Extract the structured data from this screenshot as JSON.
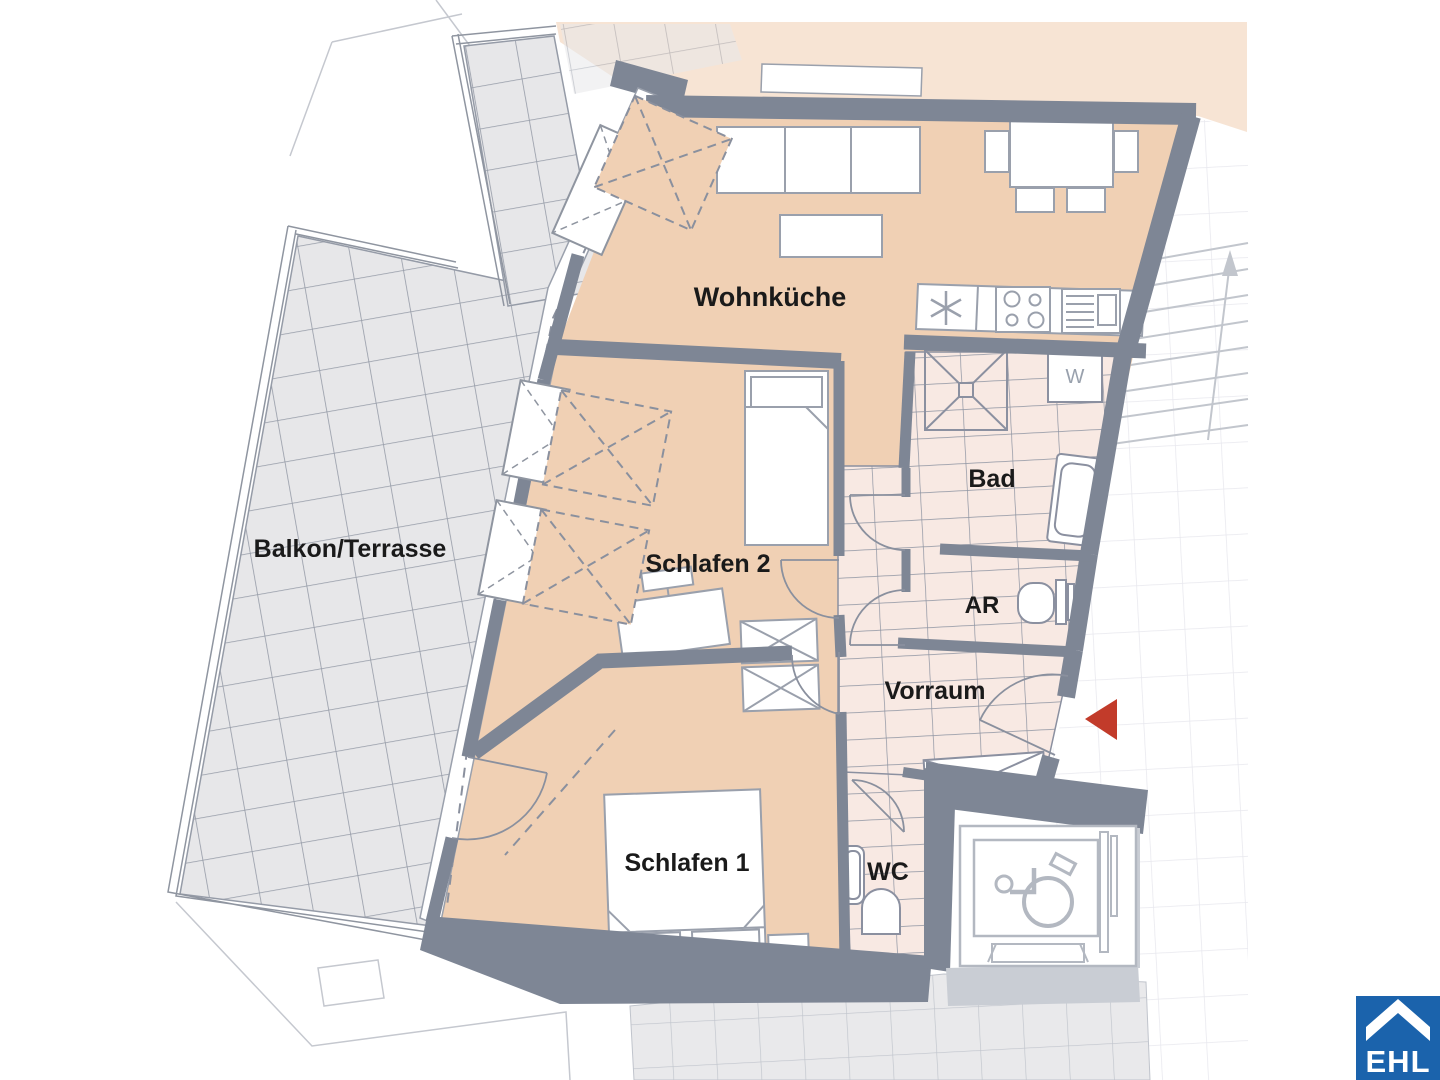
{
  "plan": {
    "type": "apartment-floor-plan",
    "rooms": {
      "wohnkueche": "Wohnküche",
      "schlafen2": "Schlafen 2",
      "schlafen1": "Schlafen 1",
      "bad": "Bad",
      "ar": "AR",
      "vorraum": "Vorraum",
      "wc": "WC",
      "balkon": "Balkon/Terrasse"
    },
    "appliances": {
      "washer": "W"
    },
    "logo": {
      "text": "EHL"
    },
    "colors": {
      "room_fill": "#f0d0b4",
      "neighbor_fill": "#f7e4d4",
      "wall": "#7e8695",
      "tile_fill": "#f8e9e3",
      "tile_line": "#8d93a1",
      "balcony_tile_fill": "#e7e7e9",
      "balcony_tile_line": "#959ba7",
      "furniture_line": "#9aa0ac",
      "entry_arrow": "#c23b2a",
      "logo_blue": "#1b63ac",
      "label_text": "#1a1a1a"
    }
  }
}
